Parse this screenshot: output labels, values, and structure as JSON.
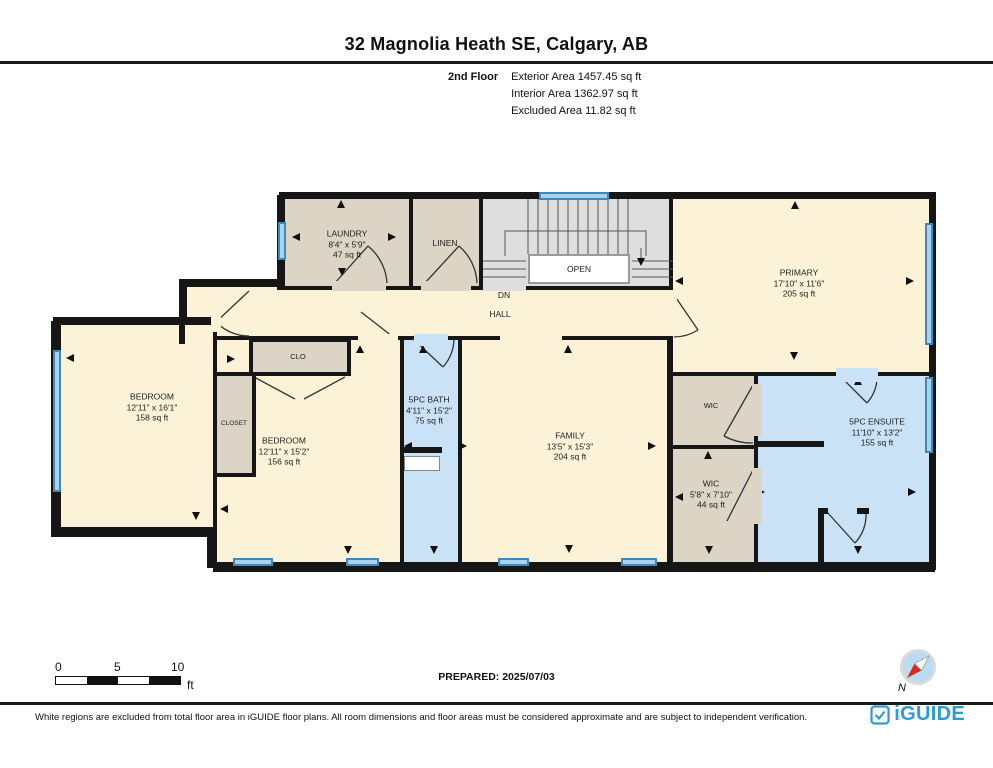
{
  "header": {
    "title": "32 Magnolia Heath SE, Calgary, AB",
    "floor_label": "2nd Floor",
    "stats": [
      "Exterior Area 1457.45 sq ft",
      "Interior Area 1362.97 sq ft",
      "Excluded Area 11.82 sq ft"
    ]
  },
  "plan": {
    "rooms": {
      "laundry": {
        "name": "LAUNDRY",
        "dims": "8'4\" x 5'9\"",
        "area": "47 sq ft"
      },
      "linen": {
        "name": "LINEN"
      },
      "stairs": {
        "open_label": "OPEN",
        "down_label": "DN"
      },
      "hall": {
        "name": "HALL"
      },
      "primary": {
        "name": "PRIMARY",
        "dims": "17'10\" x 11'6\"",
        "area": "205 sq ft"
      },
      "bedroom1": {
        "name": "BEDROOM",
        "dims": "12'11\" x 16'1\"",
        "area": "158 sq ft"
      },
      "bedroom2": {
        "name": "BEDROOM",
        "dims": "12'11\" x 15'2\"",
        "area": "156 sq ft"
      },
      "clo": {
        "name": "CLO"
      },
      "closet": {
        "name": "CLOSET"
      },
      "bath": {
        "name": "5PC BATH",
        "dims": "4'11\" x 15'2\"",
        "area": "75 sq ft"
      },
      "family": {
        "name": "FAMILY",
        "dims": "13'5\" x 15'3\"",
        "area": "204 sq ft"
      },
      "wic_upper": {
        "name": "WIC"
      },
      "wic_lower": {
        "name": "WIC",
        "dims": "5'8\" x 7'10\"",
        "area": "44 sq ft"
      },
      "ensuite": {
        "name": "5PC ENSUITE",
        "dims": "11'10\" x 13'2\"",
        "area": "155 sq ft"
      }
    },
    "colors": {
      "room_cream": "#FBF2D8",
      "room_tan": "#DCD4C4",
      "bathroom_blue": "#C9E2F5",
      "stairs_gray": "#DEDEDE",
      "window_blue": "#3F88BC",
      "wall_black": "#161616"
    }
  },
  "scale_bar": {
    "ticks": [
      "0",
      "5",
      "10"
    ],
    "unit": "ft"
  },
  "prepared": "PREPARED: 2025/07/03",
  "compass": {
    "north_label": "N"
  },
  "footer": {
    "disclaimer": "White regions are excluded from total floor area in iGUIDE floor plans. All room dimensions and floor areas must be considered approximate and are subject to independent verification.",
    "brand": "iGUIDE",
    "brand_color": "#2E9BD6"
  }
}
